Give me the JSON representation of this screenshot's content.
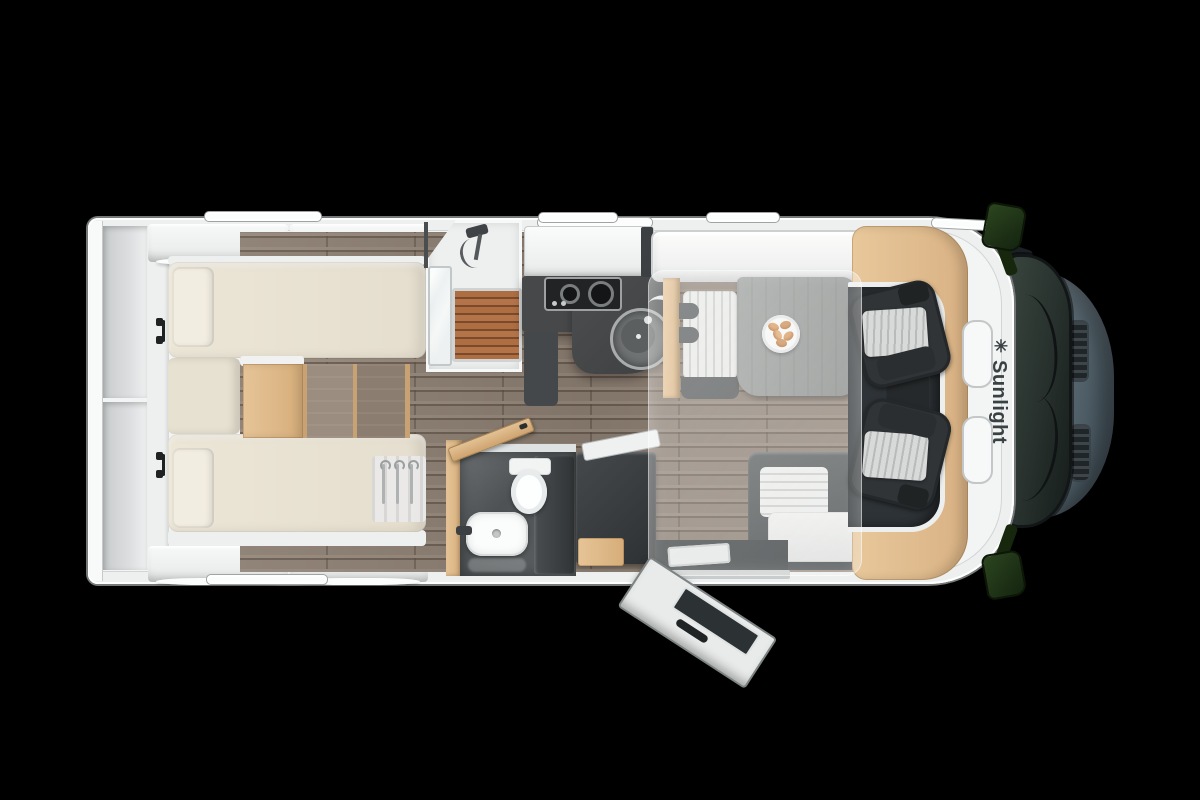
{
  "canvas": {
    "width": 1200,
    "height": 800,
    "background": "#000000"
  },
  "brand": {
    "name": "Sunlight",
    "logo_star": "✳"
  },
  "floorplan": {
    "regions": [
      "rear-twin-beds",
      "rear-wardrobes",
      "shower",
      "kitchen",
      "bathroom",
      "fridge-cabinet",
      "dinette",
      "side-bench",
      "drop-down-bed-overlay",
      "cab-seats",
      "entry-door-open"
    ],
    "colors": {
      "body_white": "#f3f4f4",
      "wall_line": "#d2d5d5",
      "floor_wood": "#8b7d71",
      "accent_wood": "#e0bd8e",
      "mattress_cream": "#e9e3d4",
      "counter_dark": "#46484a",
      "cabinet_dark": "#3a3d3f",
      "table_gray": "#8e9290",
      "seat_graphite": "#33373a",
      "seat_cover": "#d6d8d7",
      "teak_shower": "#a5683c",
      "hood_slate": "#5c6b74",
      "windshield_glass": "#232b28",
      "mirror_green": "#1e3313",
      "drop_bed_overlay": "rgba(250,250,248,0.28)",
      "logo_text": "#3a4143"
    }
  }
}
